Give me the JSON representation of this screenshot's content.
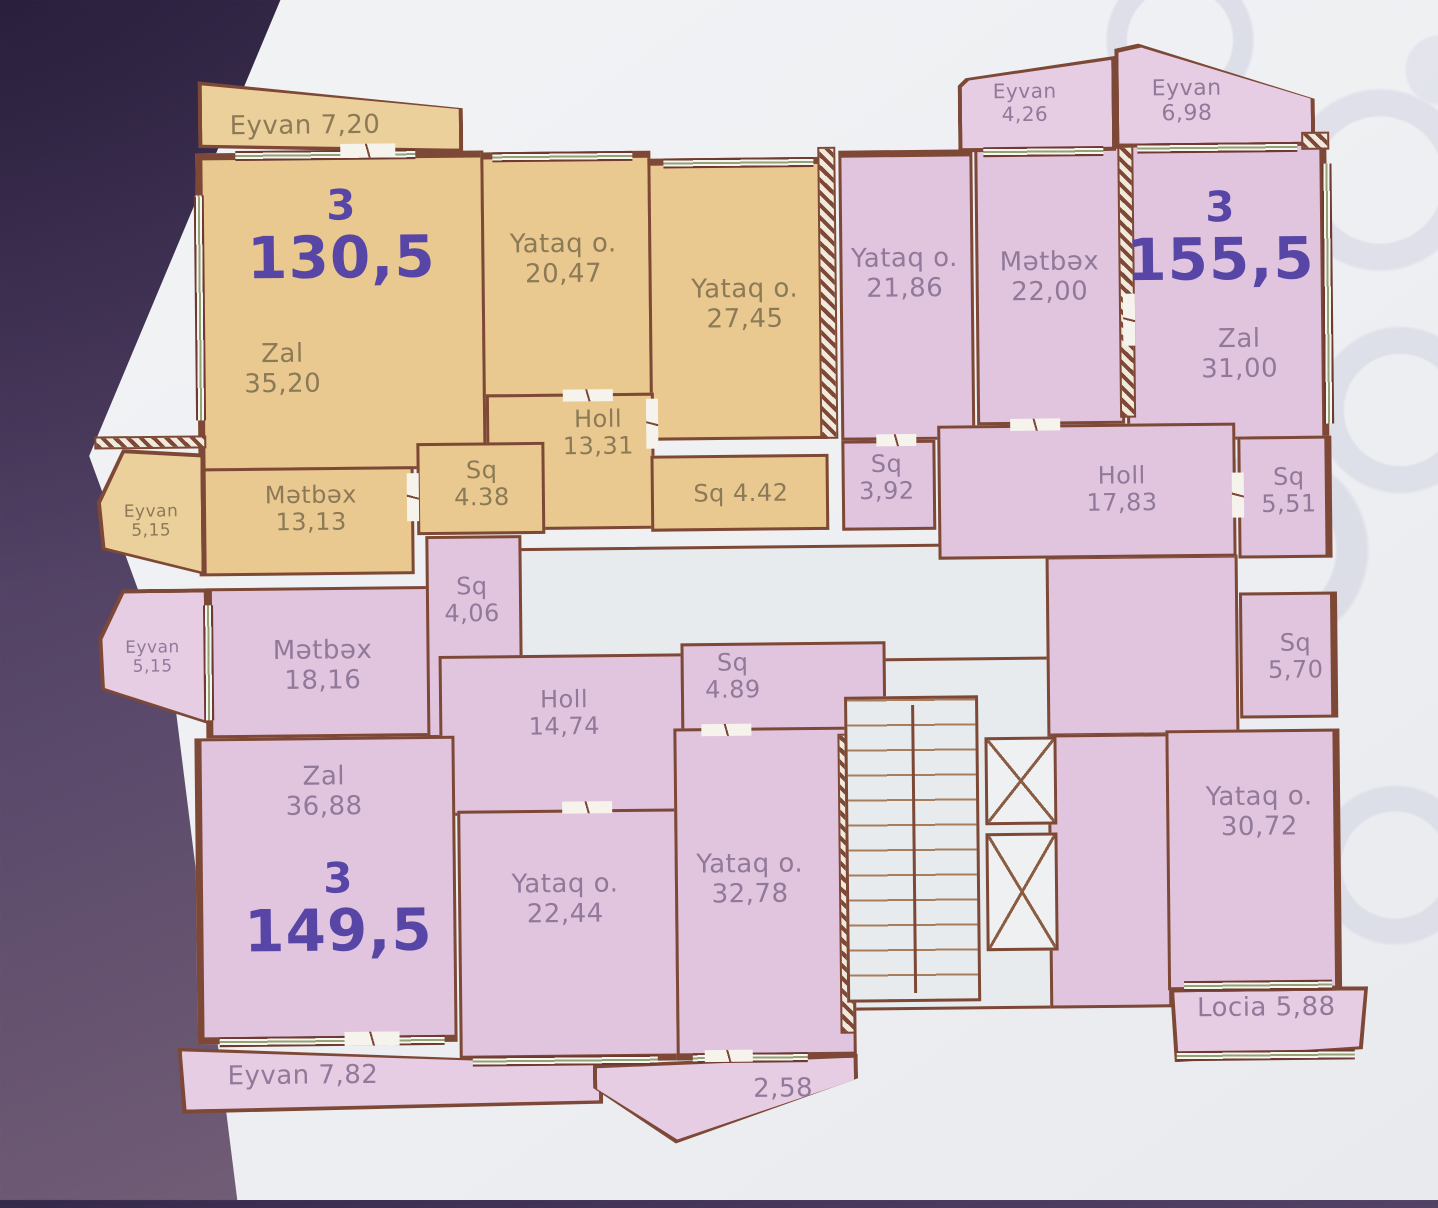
{
  "colors": {
    "backdrop_top": "#35294a",
    "backdrop_bottom": "#8a7183",
    "paper": "#eef0f3",
    "tan_fill": "#e9c990",
    "pink_fill": "#e1c5df",
    "wall": "#7d4936",
    "core_fill": "#e8ebee",
    "unit_number_text": "#5846a6",
    "tan_label_text": "#8c7a57",
    "pink_label_text": "#91799a"
  },
  "a130": {
    "unit_num": "3",
    "unit_area": "130,5",
    "eyvan_top": "Eyvan 7,20",
    "zal": "Zal\n35,20",
    "yataq_1": "Yataq o.\n20,47",
    "yataq_2": "Yataq o.\n27,45",
    "holl": "Holl\n13,31",
    "sq_1": "Sq\n4.38",
    "sq_2": "Sq 4.42",
    "metbex": "Mətbəx\n13,13",
    "eyvan_side": "Eyvan\n5,15"
  },
  "a155": {
    "unit_num": "3",
    "unit_area": "155,5",
    "eyvan_1": "Eyvan\n4,26",
    "eyvan_2": "Eyvan\n6,98",
    "yataq_1": "Yataq o.\n21,86",
    "metbex": "Mətbəx\n22,00",
    "zal": "Zal\n31,00",
    "sq_1": "Sq\n3,92",
    "holl": "Holl\n17,83",
    "sq_2": "Sq\n5,51",
    "sq_3": "Sq\n5,70",
    "yataq_2": "Yataq o.\n30,72",
    "locia": "Locia 5,88"
  },
  "a149": {
    "unit_num": "3",
    "unit_area": "149,5",
    "eyvan_side": "Eyvan\n5,15",
    "metbex": "Mətbəx\n18,16",
    "sq_1": "Sq\n4,06",
    "holl": "Holl\n14,74",
    "sq_2": "Sq\n4.89",
    "zal": "Zal\n36,88",
    "yataq_1": "Yataq o.\n22,44",
    "yataq_2": "Yataq o.\n32,78",
    "eyvan_bottom": "Eyvan 7,82",
    "balcony": "2,58"
  }
}
